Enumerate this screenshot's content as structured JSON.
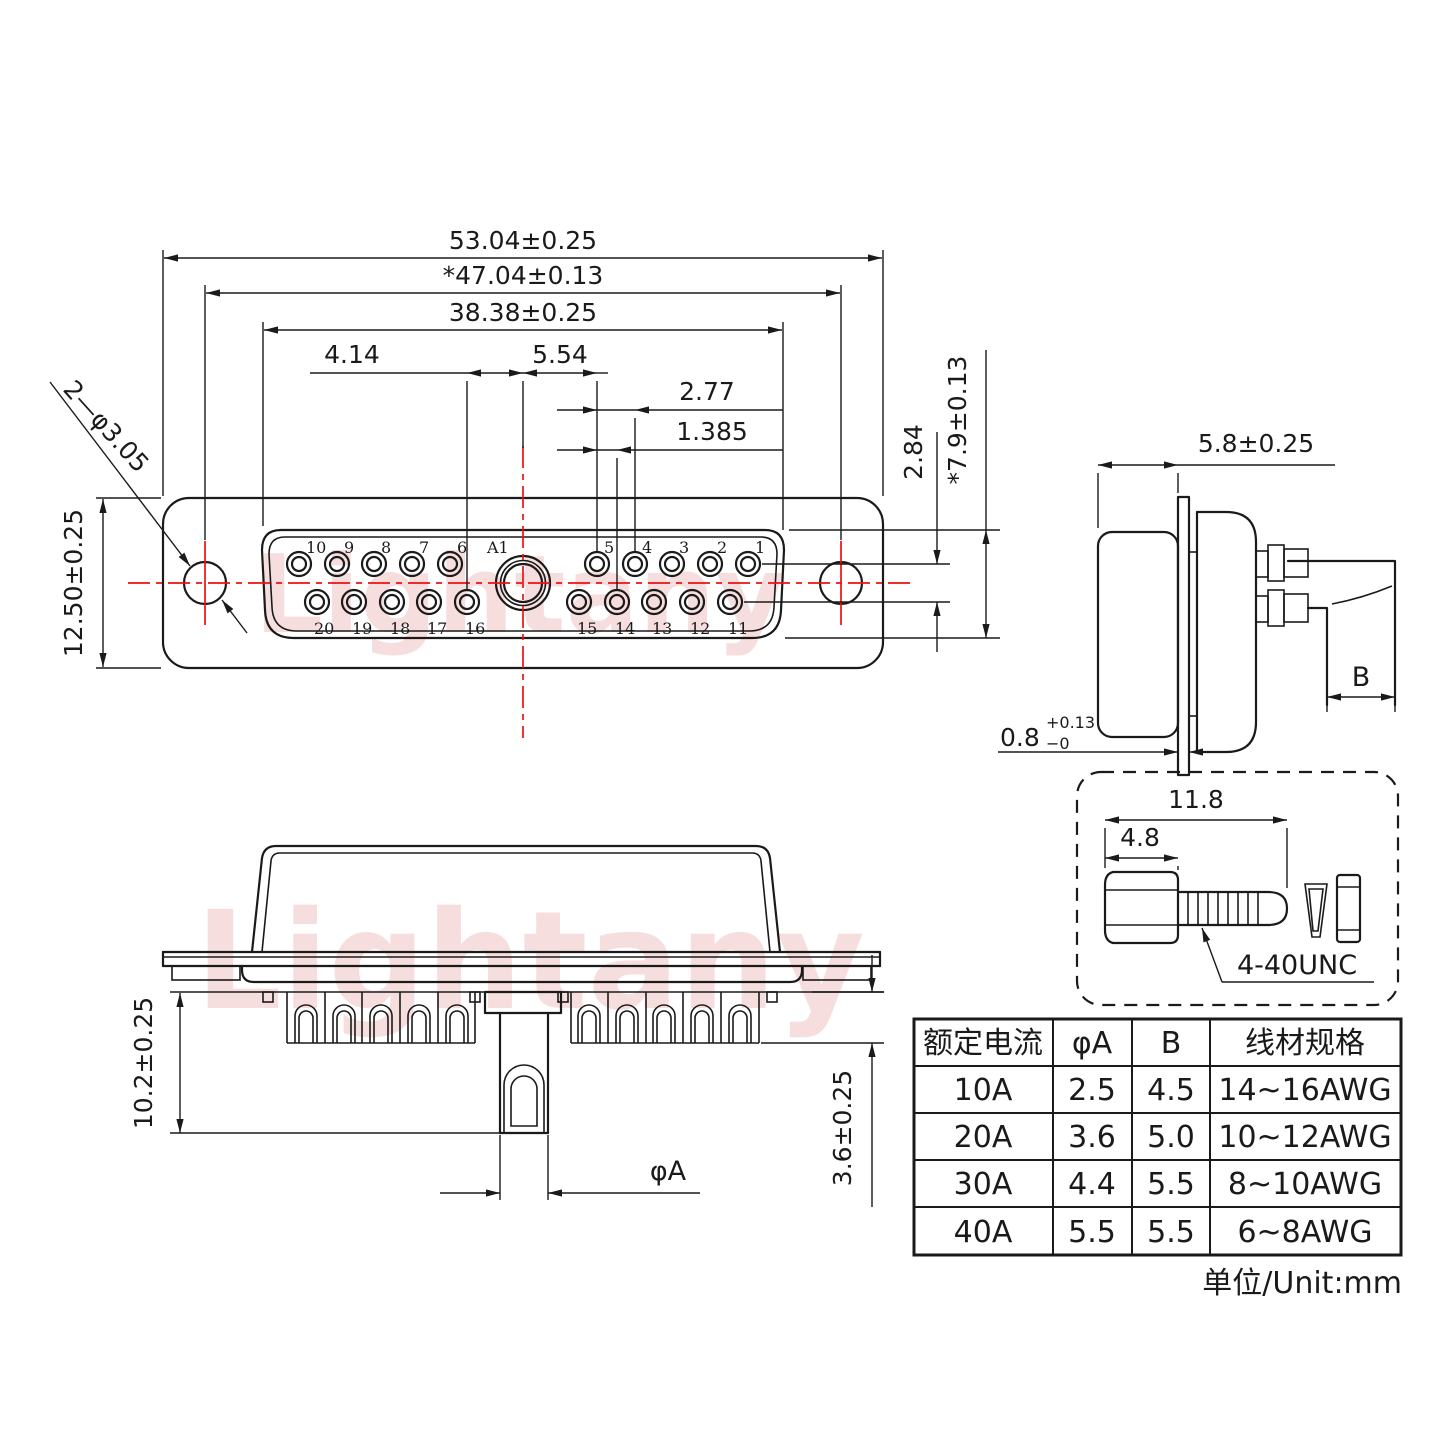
{
  "drawing": {
    "watermark": "Lightany",
    "unit_note": "单位/Unit:mm",
    "colors": {
      "line": "#1a1a1a",
      "centerline_red": "#ee1111",
      "pin_number_red": "#e01010",
      "watermark_pink": "#e89595"
    }
  },
  "front_view": {
    "dims": {
      "overall_width": "53.04±0.25",
      "mount_hole_spacing": "*47.04±0.13",
      "insert_width": "38.38±0.25",
      "pin16_to_center": "4.14",
      "center_to_pin5": "5.54",
      "pin_pitch": "2.77",
      "row_offset": "1.385",
      "row_spacing": "2.84",
      "insert_height": "*7.9±0.13",
      "shell_height": "12.50±0.25",
      "mount_hole_callout": "2—φ3.05"
    },
    "pins": {
      "big": "A1",
      "top": [
        "10",
        "9",
        "8",
        "7",
        "6",
        "5",
        "4",
        "3",
        "2",
        "1"
      ],
      "bottom": [
        "20",
        "19",
        "18",
        "17",
        "16",
        "15",
        "14",
        "13",
        "12",
        "11"
      ]
    }
  },
  "side_view": {
    "dims": {
      "front_depth": "5.8±0.25",
      "wire_width": "B",
      "flange_thickness_value": "0.8",
      "flange_thickness_plus": "+0.13",
      "flange_thickness_minus": "−0"
    }
  },
  "section_view": {
    "dims": {
      "body_height": "10.2±0.25",
      "cup_depth": "3.6±0.25",
      "post_diameter": "φA"
    }
  },
  "screw_detail": {
    "dims": {
      "total_length": "11.8",
      "head_length": "4.8"
    },
    "thread_spec": "4-40UNC"
  },
  "spec_table": {
    "headers": [
      "额定电流",
      "φA",
      "B",
      "线材规格"
    ],
    "rows": [
      [
        "10A",
        "2.5",
        "4.5",
        "14~16AWG"
      ],
      [
        "20A",
        "3.6",
        "5.0",
        "10~12AWG"
      ],
      [
        "30A",
        "4.4",
        "5.5",
        "8~10AWG"
      ],
      [
        "40A",
        "5.5",
        "5.5",
        "6~8AWG"
      ]
    ]
  }
}
